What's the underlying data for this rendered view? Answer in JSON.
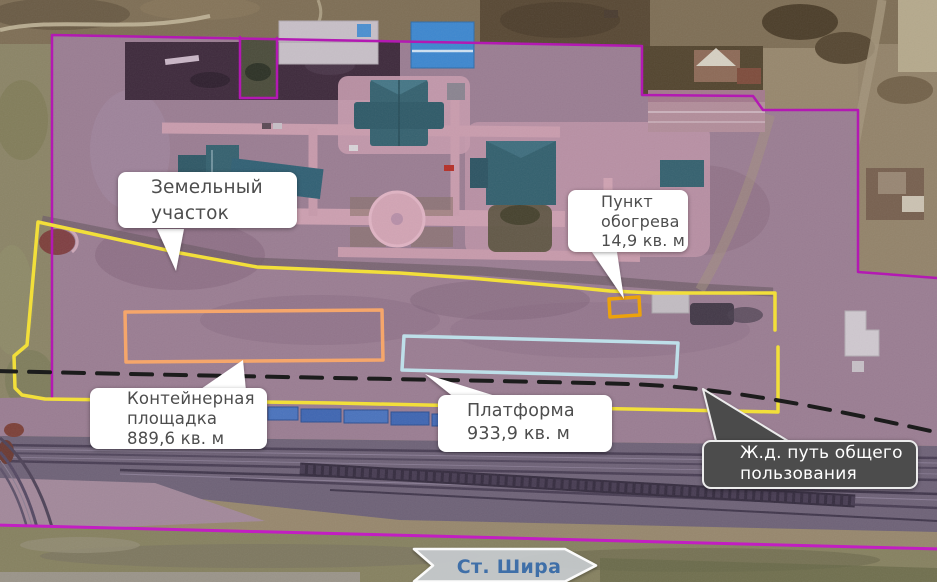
{
  "map": {
    "callouts": {
      "land_plot": {
        "lines": [
          "Земельный",
          "участок"
        ]
      },
      "heating_point": {
        "lines": [
          "Пункт",
          "обогрева",
          "14,9 кв. м"
        ]
      },
      "container_area": {
        "lines": [
          "Контейнерная",
          "площадка",
          "889,6 кв. м"
        ]
      },
      "platform": {
        "lines": [
          "Платформа",
          "933,9 кв. м"
        ]
      },
      "railway": {
        "lines": [
          "Ж.д. путь общего",
          "пользования"
        ]
      }
    },
    "station_arrow": {
      "label": "Ст. Шира"
    },
    "colors": {
      "land_plot_boundary": "#b319b3",
      "allotment_outline": "#f2df3a",
      "container_area_outline": "#f5a66b",
      "platform_outline": "#bedfe9",
      "heating_point_outline": "#eca20c",
      "railway_axis": "#1c1c1c",
      "station_text": "#3f6fa8"
    }
  }
}
